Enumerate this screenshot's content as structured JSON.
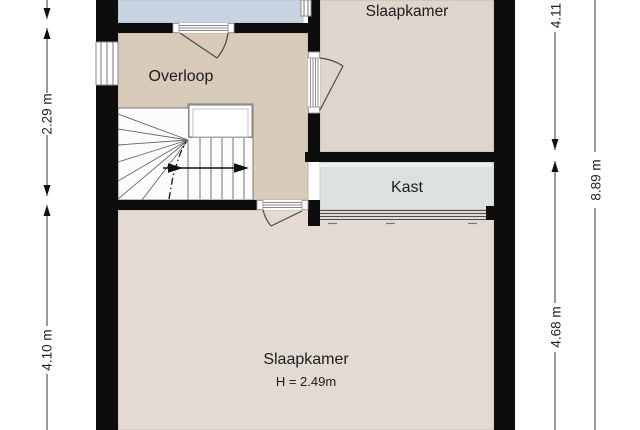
{
  "plan": {
    "rooms": {
      "bedroom_top": "Slaapkamer",
      "landing": "Overloop",
      "closet": "Kast",
      "bedroom_main": "Slaapkamer",
      "bedroom_main_height": "H = 2.49m"
    },
    "dimensions": {
      "left_upper": "2.29 m",
      "left_lower": "4.10 m",
      "right_inner_upper": "4.11 m",
      "right_inner_lower": "4.68 m",
      "right_outer": "8.89 m"
    },
    "colors": {
      "wall": "#0d0d0d",
      "room_top_blue": "#c6d4e1",
      "landing": "#d8cbba",
      "bedroom_top": "#e0d5cd",
      "closet": "#dde1df",
      "bedroom_main": "#e3dad3"
    }
  }
}
